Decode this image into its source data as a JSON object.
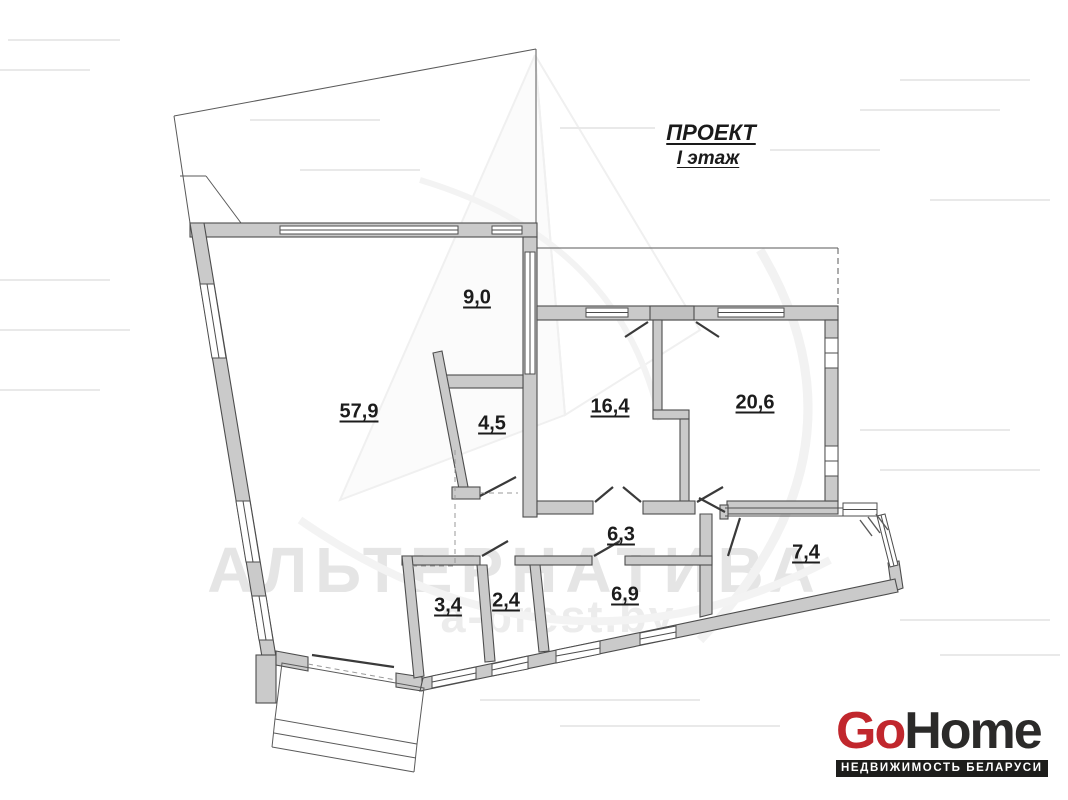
{
  "title": {
    "project": "ПРОЕКТ",
    "floor": "I этаж"
  },
  "floorplan": {
    "rooms": [
      {
        "id": "hall-top",
        "area": "9,0"
      },
      {
        "id": "main-room",
        "area": "57,9"
      },
      {
        "id": "room-4-5",
        "area": "4,5"
      },
      {
        "id": "room-16-4",
        "area": "16,4"
      },
      {
        "id": "room-20-6",
        "area": "20,6"
      },
      {
        "id": "corridor",
        "area": "6,3"
      },
      {
        "id": "room-7-4",
        "area": "7,4"
      },
      {
        "id": "room-3-4",
        "area": "3,4"
      },
      {
        "id": "room-2-4",
        "area": "2,4"
      },
      {
        "id": "room-6-9",
        "area": "6,9"
      }
    ],
    "wall_color": "#cacaca",
    "line_color": "#4d4d4d"
  },
  "watermark": {
    "brand": "АЛЬТЕРНАТИВА",
    "site": "a-brest.by"
  },
  "logo": {
    "go": "Go",
    "home": "Home",
    "tagline": "НЕДВИЖИМОСТЬ БЕЛАРУСИ",
    "go_color": "#c1272d",
    "home_color": "#2b2a29",
    "tagline_bg": "#1d1d1b"
  }
}
